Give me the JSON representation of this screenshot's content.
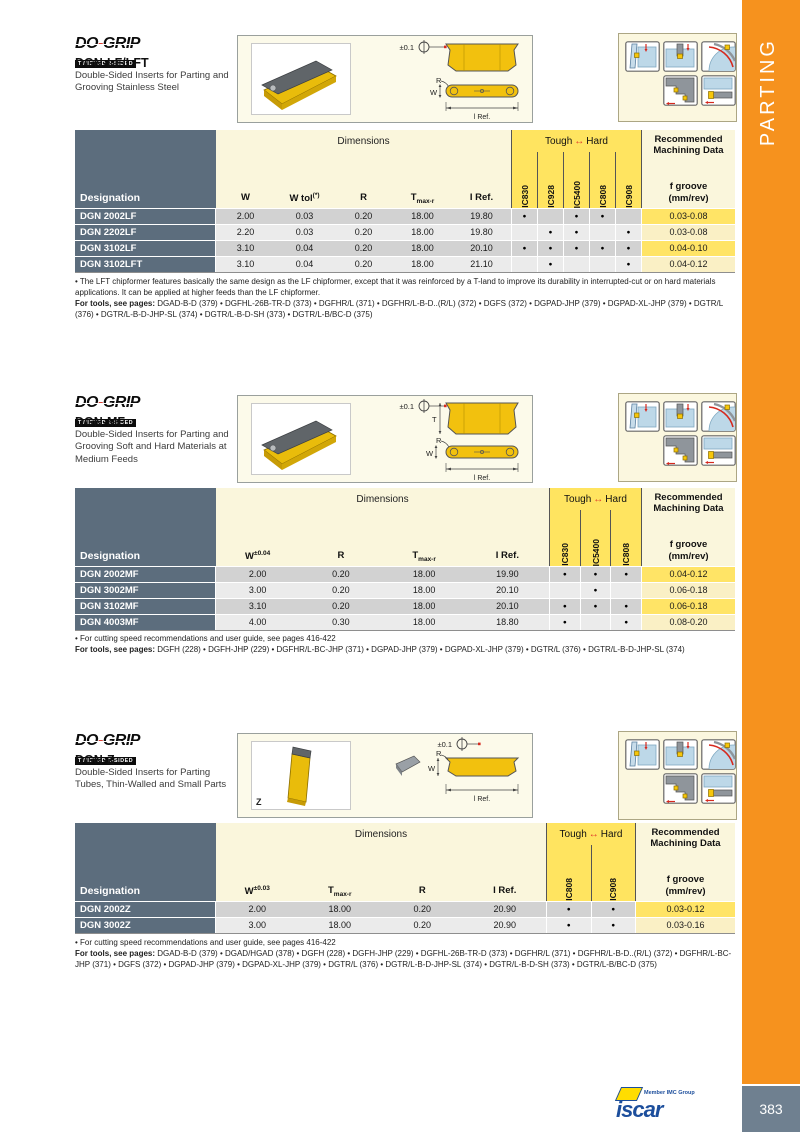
{
  "page": {
    "tab": "PARTING",
    "number": "383",
    "tab_color": "#F6921E",
    "pagebox_color": "#6F8090"
  },
  "brand": {
    "do": "DO",
    "dash": "-",
    "grip": "GRIP",
    "tagline": "TWISTED 2-SIDED"
  },
  "footer": {
    "member": "Member IMC Group",
    "iscar": "iscar"
  },
  "labels": {
    "dimensions": "Dimensions",
    "tough": "Tough",
    "arrow": "↔",
    "hard": "Hard",
    "designation": "Designation",
    "machining": "Recommended Machining Data",
    "fgroove": "f groove",
    "mmrev": "(mm/rev)"
  },
  "drawing": {
    "tol": "±0.1",
    "r": "R",
    "w": "W",
    "t": "T",
    "z": "Z",
    "lref": "l Ref."
  },
  "sections": [
    {
      "title": "DGN-LF/LFT",
      "subtitle": "Double-Sided Inserts for Parting and Grooving Stainless Steel",
      "table": {
        "dim_headers": [
          {
            "t": "W"
          },
          {
            "t": "W tol",
            "sup": "(*)"
          },
          {
            "t": "R"
          },
          {
            "t": "T",
            "sub": "max-r"
          },
          {
            "t": "I Ref."
          }
        ],
        "grades": [
          "IC830",
          "IC928",
          "IC5400",
          "IC808",
          "IC908"
        ],
        "rows": [
          {
            "d": "DGN 2002LF",
            "v": [
              "2.00",
              "0.03",
              "0.20",
              "18.00",
              "19.80"
            ],
            "dots": [
              "●",
              "",
              "●",
              "●",
              ""
            ],
            "f": "0.03-0.08"
          },
          {
            "d": "DGN 2202LF",
            "v": [
              "2.20",
              "0.03",
              "0.20",
              "18.00",
              "19.80"
            ],
            "dots": [
              "",
              "●",
              "●",
              "",
              "●"
            ],
            "f": "0.03-0.08"
          },
          {
            "d": "DGN 3102LF",
            "v": [
              "3.10",
              "0.04",
              "0.20",
              "18.00",
              "20.10"
            ],
            "dots": [
              "●",
              "●",
              "●",
              "●",
              "●"
            ],
            "f": "0.04-0.10"
          },
          {
            "d": "DGN 3102LFT",
            "v": [
              "3.10",
              "0.04",
              "0.20",
              "18.00",
              "21.10"
            ],
            "dots": [
              "",
              "●",
              "",
              "",
              "●"
            ],
            "f": "0.04-0.12"
          }
        ]
      },
      "note": "• The LFT chipformer features basically the same design as the LF chipformer, except that it was reinforced by a T-land to improve its durability in interrupted-cut or on hard materials applications. It can be applied at higher feeds than the LF chipformer.",
      "tools_prefix": "For tools, see pages:",
      "tools": "DGAD-B-D (379) • DGFHL-26B-TR-D (373) • DGFHR/L (371) • DGFHR/L-B-D..(R/L) (372) • DGFS (372) • DGPAD-JHP (379) • DGPAD-XL-JHP (379) • DGTR/L (376) • DGTR/L-B-D-JHP-SL (374) • DGTR/L-B-D-SH (373) • DGTR/L-B/BC-D (375)"
    },
    {
      "title": "DGN-MF",
      "subtitle": "Double-Sided Inserts for Parting and Grooving Soft and Hard Materials at Medium Feeds",
      "table": {
        "dim_headers": [
          {
            "t": "W",
            "sup": "±0.04"
          },
          {
            "t": "R"
          },
          {
            "t": "T",
            "sub": "max-r"
          },
          {
            "t": "I Ref."
          }
        ],
        "grades": [
          "IC830",
          "IC5400",
          "IC808"
        ],
        "rows": [
          {
            "d": "DGN 2002MF",
            "v": [
              "2.00",
              "0.20",
              "18.00",
              "19.90"
            ],
            "dots": [
              "●",
              "●",
              "●"
            ],
            "f": "0.04-0.12"
          },
          {
            "d": "DGN 3002MF",
            "v": [
              "3.00",
              "0.20",
              "18.00",
              "20.10"
            ],
            "dots": [
              "",
              "●",
              ""
            ],
            "f": "0.06-0.18"
          },
          {
            "d": "DGN 3102MF",
            "v": [
              "3.10",
              "0.20",
              "18.00",
              "20.10"
            ],
            "dots": [
              "●",
              "●",
              "●"
            ],
            "f": "0.06-0.18"
          },
          {
            "d": "DGN 4003MF",
            "v": [
              "4.00",
              "0.30",
              "18.00",
              "18.80"
            ],
            "dots": [
              "●",
              "",
              "●"
            ],
            "f": "0.08-0.20"
          }
        ]
      },
      "note": "• For cutting speed recommendations and user guide, see pages 416-422",
      "tools_prefix": "For tools, see pages:",
      "tools": "DGFH (228) • DGFH-JHP (229) • DGFHR/L-BC-JHP (371) • DGPAD-JHP (379) • DGPAD-XL-JHP (379) • DGTR/L (376) • DGTR/L-B-D-JHP-SL (374)"
    },
    {
      "title": "DGN-Z",
      "subtitle": "Double-Sided Inserts for Parting Tubes, Thin-Walled and Small Parts",
      "table": {
        "dim_headers": [
          {
            "t": "W",
            "sup": "±0.03"
          },
          {
            "t": "T",
            "sub": "max-r"
          },
          {
            "t": "R"
          },
          {
            "t": "I Ref."
          }
        ],
        "grades": [
          "IC808",
          "IC908"
        ],
        "rows": [
          {
            "d": "DGN 2002Z",
            "v": [
              "2.00",
              "18.00",
              "0.20",
              "20.90"
            ],
            "dots": [
              "●",
              "●"
            ],
            "f": "0.03-0.12"
          },
          {
            "d": "DGN 3002Z",
            "v": [
              "3.00",
              "18.00",
              "0.20",
              "20.90"
            ],
            "dots": [
              "●",
              "●"
            ],
            "f": "0.03-0.16"
          }
        ]
      },
      "note": "• For cutting speed recommendations and user guide, see pages 416-422",
      "tools_prefix": "For tools, see pages:",
      "tools": "DGAD-B-D (379) • DGAD/HGAD (378) • DGFH (228) • DGFH-JHP (229) • DGFHL-26B-TR-D (373) • DGFHR/L (371) • DGFHR/L-B-D..(R/L) (372) • DGFHR/L-BC-JHP (371) • DGFS (372) • DGPAD-JHP (379) • DGPAD-XL-JHP (379) • DGTR/L (376) • DGTR/L-B-D-JHP-SL (374) • DGTR/L-B-D-SH (373) • DGTR/L-B/BC-D (375)"
    }
  ]
}
